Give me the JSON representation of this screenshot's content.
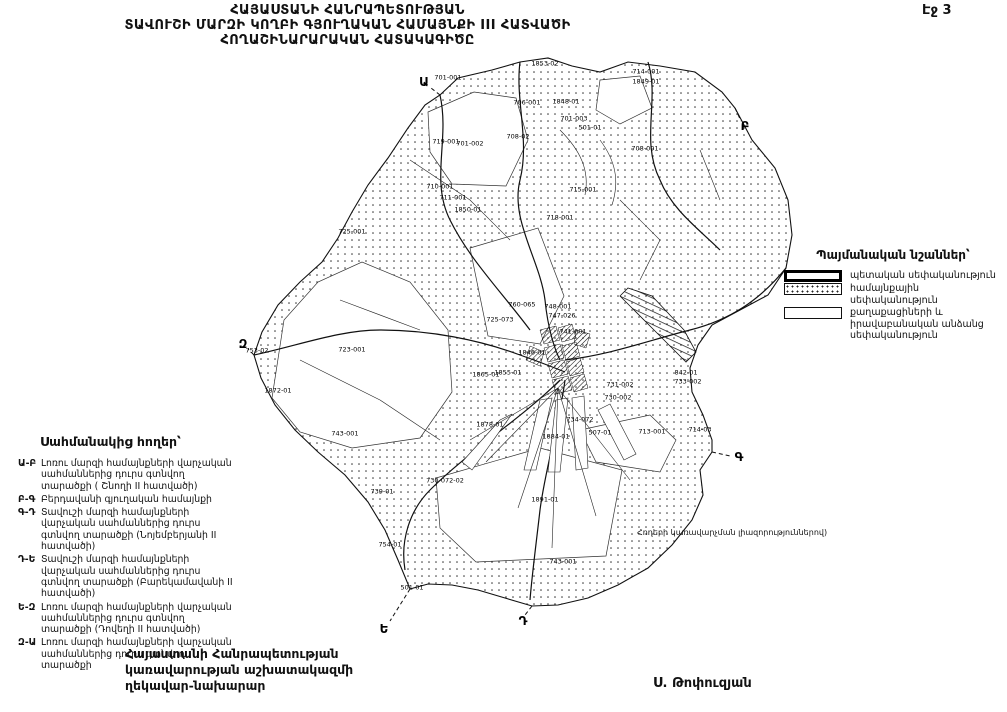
{
  "page": {
    "number_label": "Էջ 3"
  },
  "title": {
    "line1": "ՀԱՅԱՍՏԱՆԻ ՀԱՆՐԱՊԵՏՈՒԹՅԱՆ",
    "line2": "ՏԱՎՈՒՇԻ ՄԱՐԶԻ ԿՈՂԲԻ ԳՅՈՒՂԱԿԱՆ ՀԱՄԱՅՆՔԻ III ՀԱՏՎԱԾԻ",
    "line3": "ՀՈՂԱՇԻՆԱՐԱՐԱԿԱՆ ՀԱՏԱԿԱԳԻԾԸ"
  },
  "legend": {
    "heading": "Պայմանական նշաններ՝",
    "items": [
      {
        "swatch": "state",
        "label": "պետական սեփականություն"
      },
      {
        "swatch": "community",
        "label": "համայնքային սեփականություն"
      },
      {
        "swatch": "private",
        "label": "քաղաքացիների և իրավաբանական անձանց սեփականություն"
      }
    ]
  },
  "border_lands": {
    "heading": "Սահմանակից հողեր՝",
    "items": [
      {
        "code": "Ա-Բ",
        "text": "Լոռու մարզի համայնքների վարչական սահմաններից դուրս գտնվող տարածքի ( Շնողի II հատվածի)"
      },
      {
        "code": "Բ-Գ",
        "text": "Բերդավանի գյուղական համայնքի"
      },
      {
        "code": "Գ-Դ",
        "text": "Տավուշի մարզի համայնքների վարչական սահմաններից դուրս գտնվող տարածքի (Նոյեմբերյանի II հատվածի)"
      },
      {
        "code": "Դ-Ե",
        "text": "Տավուշի մարզի համայնքների վարչական սահմաններից դուրս գտնվող տարածքի (Բարեկամավանի II հատվածի)"
      },
      {
        "code": "Ե-Զ",
        "text": "Լոռու մարզի համայնքների վարչական սահմաններից դուրս գտնվող տարածքի (Դովեղի II հատվածի)"
      },
      {
        "code": "Զ-Ա",
        "text": "Լոռու մարզի համայնքների վարչական սահմաններից դուրս գտնվող տարածքի"
      }
    ]
  },
  "official": {
    "line1": "Հայաստանի Հանրապետության",
    "line2": "կառավարության աշխատակազմի",
    "line3": "ղեկավար-նախարար",
    "signature": "Ս. Թոփուզյան"
  },
  "map": {
    "annotation": "Հողերի կառավարչման լիազորություններով)",
    "colors": {
      "ink": "#111111",
      "paper": "#ffffff"
    },
    "boundary_letters": [
      {
        "letter": "Ա",
        "x": 424,
        "y": 82
      },
      {
        "letter": "Բ",
        "x": 745,
        "y": 126
      },
      {
        "letter": "Գ",
        "x": 739,
        "y": 457
      },
      {
        "letter": "Դ",
        "x": 523,
        "y": 621
      },
      {
        "letter": "Ե",
        "x": 384,
        "y": 629
      },
      {
        "letter": "Զ",
        "x": 243,
        "y": 344
      }
    ],
    "parcel_labels": [
      {
        "t": "1853-02",
        "x": 545,
        "y": 64
      },
      {
        "t": "701-001",
        "x": 448,
        "y": 78
      },
      {
        "t": "714-001",
        "x": 646,
        "y": 72
      },
      {
        "t": "1849-01",
        "x": 646,
        "y": 82
      },
      {
        "t": "706-001",
        "x": 527,
        "y": 103
      },
      {
        "t": "1848-01",
        "x": 566,
        "y": 102
      },
      {
        "t": "701-003",
        "x": 574,
        "y": 119
      },
      {
        "t": "501-01",
        "x": 590,
        "y": 128
      },
      {
        "t": "719-001",
        "x": 446,
        "y": 142
      },
      {
        "t": "701-002",
        "x": 470,
        "y": 144
      },
      {
        "t": "708-02",
        "x": 518,
        "y": 137
      },
      {
        "t": "708-001",
        "x": 645,
        "y": 149
      },
      {
        "t": "710-001",
        "x": 440,
        "y": 187
      },
      {
        "t": "711-001",
        "x": 453,
        "y": 198
      },
      {
        "t": "1850-01",
        "x": 468,
        "y": 210
      },
      {
        "t": "715-001",
        "x": 583,
        "y": 190
      },
      {
        "t": "718-001",
        "x": 560,
        "y": 218
      },
      {
        "t": "725-001",
        "x": 352,
        "y": 232
      },
      {
        "t": "753-02",
        "x": 257,
        "y": 351
      },
      {
        "t": "723-001",
        "x": 352,
        "y": 350
      },
      {
        "t": "1872-01",
        "x": 278,
        "y": 391
      },
      {
        "t": "743-001",
        "x": 345,
        "y": 434
      },
      {
        "t": "725-073",
        "x": 500,
        "y": 320
      },
      {
        "t": "760-065",
        "x": 522,
        "y": 305
      },
      {
        "t": "748-001",
        "x": 558,
        "y": 307
      },
      {
        "t": "747-026",
        "x": 562,
        "y": 316
      },
      {
        "t": "741-001",
        "x": 573,
        "y": 332
      },
      {
        "t": "1846-01",
        "x": 532,
        "y": 353
      },
      {
        "t": "1865-01",
        "x": 486,
        "y": 375
      },
      {
        "t": "1855-01",
        "x": 508,
        "y": 373
      },
      {
        "t": "731-002",
        "x": 620,
        "y": 385
      },
      {
        "t": "730-002",
        "x": 618,
        "y": 398
      },
      {
        "t": "842-01",
        "x": 686,
        "y": 373
      },
      {
        "t": "733-002",
        "x": 688,
        "y": 382
      },
      {
        "t": "734-072",
        "x": 580,
        "y": 420
      },
      {
        "t": "1878-01",
        "x": 490,
        "y": 425
      },
      {
        "t": "507-01",
        "x": 600,
        "y": 433
      },
      {
        "t": "713-001",
        "x": 652,
        "y": 432
      },
      {
        "t": "714-03",
        "x": 700,
        "y": 430
      },
      {
        "t": "1884-01",
        "x": 556,
        "y": 437
      },
      {
        "t": "730-072-02",
        "x": 445,
        "y": 481
      },
      {
        "t": "739-01",
        "x": 382,
        "y": 492
      },
      {
        "t": "1891-01",
        "x": 545,
        "y": 500
      },
      {
        "t": "754-01",
        "x": 390,
        "y": 545
      },
      {
        "t": "501-01",
        "x": 412,
        "y": 588
      },
      {
        "t": "743-001",
        "x": 563,
        "y": 562
      }
    ]
  }
}
